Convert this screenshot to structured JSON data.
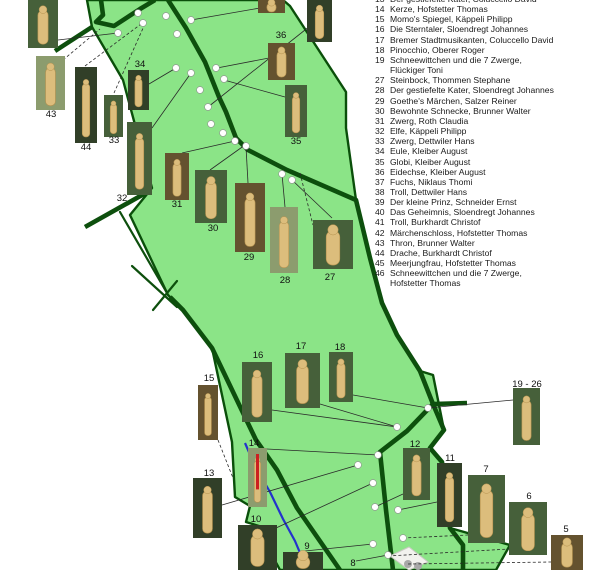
{
  "map": {
    "colors": {
      "park_fill": "#8be487",
      "park_border": "#0a4f0a",
      "trail": "#0d4f0d",
      "stream": "#2433cc",
      "connector": "#2a2a2a",
      "dot_fill": "#ffffff",
      "dot_stroke": "#8f8f8f",
      "gray_dot": "#a8a8a8",
      "building_fill": "#f2f2ee",
      "building_stroke": "#c9c9c2",
      "sculpture": "#dcbd7c",
      "sculpture_edge": "#b5924f",
      "photo_bg": {
        "forest": "#46603a",
        "dark": "#313f28",
        "brown": "#64522f",
        "light": "#8c9c6e"
      }
    },
    "park_polygon": "87,0 283,0 290,6 346,92 346,128 356,200 370,258 382,303 397,335 420,371 433,375 444,430 430,448 442,462 450,528 510,545 496,570 280,570 268,548 272,530 246,522 250,506 235,497 232,442 212,348 183,310 168,295 130,215 152,188 123,80 92,27",
    "trails_thick": [
      "101,0 103,15 96,22 114,26 140,9 155,0",
      "168,0 186,28 205,62 219,97 226,112 236,138 248,150 287,170 356,200 370,258 382,303 397,335 420,371 433,404 444,430 430,448 442,462 450,528 463,545 463,570",
      "92,27 55,51",
      "85,227 151,190",
      "170,297 183,310 212,348 256,440 277,470 297,508 340,570",
      "433,404 407,431 380,452 386,510 393,570",
      "433,404 467,403"
    ],
    "trails_thin": [
      "132,266 177,307",
      "153,310 177,281",
      "120,212 167,293"
    ],
    "stream": "245,443 255,466 270,492 283,519 295,541 303,560 305,568",
    "building": "390,556 409,547 428,562 409,570",
    "dots": [
      [
        118,
        33
      ],
      [
        138,
        13
      ],
      [
        143,
        23
      ],
      [
        166,
        16
      ],
      [
        177,
        34
      ],
      [
        191,
        20
      ],
      [
        176,
        68
      ],
      [
        191,
        73
      ],
      [
        216,
        68
      ],
      [
        224,
        79
      ],
      [
        200,
        90
      ],
      [
        208,
        107
      ],
      [
        211,
        124
      ],
      [
        223,
        133
      ],
      [
        235,
        141
      ],
      [
        246,
        146
      ],
      [
        282,
        174
      ],
      [
        292,
        180
      ],
      [
        428,
        408
      ],
      [
        397,
        427
      ],
      [
        378,
        455
      ],
      [
        358,
        465
      ],
      [
        373,
        483
      ],
      [
        375,
        507
      ],
      [
        398,
        510
      ],
      [
        403,
        538
      ],
      [
        373,
        544
      ],
      [
        388,
        555
      ]
    ],
    "gray_dots": [
      [
        408,
        564
      ],
      [
        418,
        566
      ]
    ],
    "connectors": [
      {
        "p": "58,40 118,33",
        "dash": false
      },
      {
        "p": "63,60 100,29",
        "dash": true
      },
      {
        "p": "85,66 141,24",
        "dash": true
      },
      {
        "p": "114,93 144,26",
        "dash": true
      },
      {
        "p": "149,84 176,68",
        "dash": false
      },
      {
        "p": "152,128 191,73",
        "dash": false
      },
      {
        "p": "182,153 235,141",
        "dash": false
      },
      {
        "p": "210,170 245,145",
        "dash": false
      },
      {
        "p": "248,183 246,147",
        "dash": false
      },
      {
        "p": "285,207 282,174",
        "dash": false
      },
      {
        "p": "332,218 292,180",
        "dash": false
      },
      {
        "p": "300,173 313,225",
        "dash": true
      },
      {
        "p": "260,8 191,20",
        "dash": false
      },
      {
        "p": "310,26 208,107",
        "dash": false
      },
      {
        "p": "269,58 217,68",
        "dash": false
      },
      {
        "p": "285,97 224,80",
        "dash": false
      },
      {
        "p": "320,404 397,427",
        "dash": false
      },
      {
        "p": "353,395 428,408",
        "dash": false
      },
      {
        "p": "272,410 397,427",
        "dash": false
      },
      {
        "p": "218,440 233,478",
        "dash": true
      },
      {
        "p": "267,449 378,455",
        "dash": false
      },
      {
        "p": "222,505 358,465",
        "dash": false
      },
      {
        "p": "276,528 373,483",
        "dash": false
      },
      {
        "p": "305,551 373,544",
        "dash": false
      },
      {
        "p": "356,561 388,555",
        "dash": false
      },
      {
        "p": "403,494 375,507",
        "dash": false
      },
      {
        "p": "437,502 398,510",
        "dash": false
      },
      {
        "p": "403,538 468,535",
        "dash": true
      },
      {
        "p": "388,556 509,549",
        "dash": true
      },
      {
        "p": "408,564 551,562",
        "dash": true
      },
      {
        "p": "428,408 513,400",
        "dash": false
      }
    ],
    "photos": [
      {
        "id": "photo-top-left",
        "x": 28,
        "y": 0,
        "w": 30,
        "h": 48,
        "v": "forest"
      },
      {
        "id": "photo-top-mid",
        "x": 258,
        "y": 0,
        "w": 27,
        "h": 13,
        "v": "brown"
      },
      {
        "id": "photo-top-right",
        "x": 307,
        "y": 0,
        "w": 25,
        "h": 42,
        "v": "dark"
      },
      {
        "id": "photo-43",
        "x": 36,
        "y": 56,
        "w": 29,
        "h": 54,
        "v": "light"
      },
      {
        "id": "photo-44",
        "x": 75,
        "y": 67,
        "w": 22,
        "h": 76,
        "v": "dark"
      },
      {
        "id": "photo-34",
        "x": 128,
        "y": 70,
        "w": 21,
        "h": 40,
        "v": "dark"
      },
      {
        "id": "photo-33",
        "x": 104,
        "y": 95,
        "w": 19,
        "h": 42,
        "v": "forest"
      },
      {
        "id": "photo-36",
        "x": 268,
        "y": 43,
        "w": 27,
        "h": 37,
        "v": "brown"
      },
      {
        "id": "photo-35",
        "x": 285,
        "y": 85,
        "w": 22,
        "h": 52,
        "v": "forest"
      },
      {
        "id": "photo-32",
        "x": 127,
        "y": 122,
        "w": 25,
        "h": 73,
        "v": "forest"
      },
      {
        "id": "photo-31",
        "x": 165,
        "y": 153,
        "w": 24,
        "h": 47,
        "v": "brown"
      },
      {
        "id": "photo-30",
        "x": 195,
        "y": 170,
        "w": 32,
        "h": 53,
        "v": "forest"
      },
      {
        "id": "photo-29",
        "x": 235,
        "y": 183,
        "w": 30,
        "h": 69,
        "v": "brown"
      },
      {
        "id": "photo-28",
        "x": 270,
        "y": 207,
        "w": 28,
        "h": 66,
        "v": "light"
      },
      {
        "id": "photo-27",
        "x": 313,
        "y": 220,
        "w": 40,
        "h": 49,
        "v": "forest"
      },
      {
        "id": "photo-15",
        "x": 198,
        "y": 385,
        "w": 20,
        "h": 55,
        "v": "brown"
      },
      {
        "id": "photo-16",
        "x": 242,
        "y": 362,
        "w": 30,
        "h": 60,
        "v": "forest"
      },
      {
        "id": "photo-17",
        "x": 285,
        "y": 353,
        "w": 35,
        "h": 55,
        "v": "forest"
      },
      {
        "id": "photo-18",
        "x": 329,
        "y": 352,
        "w": 24,
        "h": 50,
        "v": "forest"
      },
      {
        "id": "photo-14",
        "x": 248,
        "y": 448,
        "w": 19,
        "h": 59,
        "v": "light",
        "red": true
      },
      {
        "id": "photo-13",
        "x": 193,
        "y": 478,
        "w": 29,
        "h": 60,
        "v": "dark"
      },
      {
        "id": "photo-10",
        "x": 238,
        "y": 525,
        "w": 39,
        "h": 45,
        "v": "dark"
      },
      {
        "id": "photo-12",
        "x": 403,
        "y": 448,
        "w": 27,
        "h": 52,
        "v": "forest"
      },
      {
        "id": "photo-11",
        "x": 437,
        "y": 463,
        "w": 25,
        "h": 64,
        "v": "dark"
      },
      {
        "id": "photo-7",
        "x": 468,
        "y": 475,
        "w": 37,
        "h": 68,
        "v": "forest"
      },
      {
        "id": "photo-6",
        "x": 509,
        "y": 502,
        "w": 38,
        "h": 53,
        "v": "forest"
      },
      {
        "id": "photo-5",
        "x": 551,
        "y": 535,
        "w": 32,
        "h": 35,
        "v": "brown"
      },
      {
        "id": "photo-19-26",
        "x": 513,
        "y": 388,
        "w": 27,
        "h": 57,
        "v": "forest"
      },
      {
        "id": "photo-bottom",
        "x": 283,
        "y": 552,
        "w": 40,
        "h": 18,
        "v": "dark"
      }
    ],
    "labels": [
      {
        "t": "43",
        "x": 51,
        "y": 117
      },
      {
        "t": "44",
        "x": 86,
        "y": 150
      },
      {
        "t": "33",
        "x": 114,
        "y": 143
      },
      {
        "t": "34",
        "x": 140,
        "y": 67
      },
      {
        "t": "32",
        "x": 122,
        "y": 201
      },
      {
        "t": "31",
        "x": 177,
        "y": 207
      },
      {
        "t": "30",
        "x": 213,
        "y": 231
      },
      {
        "t": "29",
        "x": 249,
        "y": 260
      },
      {
        "t": "28",
        "x": 285,
        "y": 283
      },
      {
        "t": "27",
        "x": 330,
        "y": 280
      },
      {
        "t": "36",
        "x": 281,
        "y": 38
      },
      {
        "t": "35",
        "x": 296,
        "y": 144
      },
      {
        "t": "15",
        "x": 209,
        "y": 381
      },
      {
        "t": "16",
        "x": 258,
        "y": 358
      },
      {
        "t": "17",
        "x": 301,
        "y": 349
      },
      {
        "t": "18",
        "x": 340,
        "y": 350
      },
      {
        "t": "14",
        "x": 254,
        "y": 446
      },
      {
        "t": "13",
        "x": 209,
        "y": 476
      },
      {
        "t": "10",
        "x": 256,
        "y": 522
      },
      {
        "t": "12",
        "x": 415,
        "y": 447
      },
      {
        "t": "11",
        "x": 450,
        "y": 461
      },
      {
        "t": "7",
        "x": 486,
        "y": 472
      },
      {
        "t": "6",
        "x": 529,
        "y": 499
      },
      {
        "t": "5",
        "x": 566,
        "y": 532
      },
      {
        "t": "19 - 26",
        "x": 527,
        "y": 387
      },
      {
        "t": "9",
        "x": 307,
        "y": 549
      },
      {
        "t": "8",
        "x": 353,
        "y": 566
      }
    ]
  },
  "legend": {
    "entries": [
      {
        "n": "13",
        "t": "Der gestiefelte Kater, Coluccello David"
      },
      {
        "n": "14",
        "t": "Kerze, Hofstetter Thomas"
      },
      {
        "n": "15",
        "t": "Momo's Spiegel, Käppeli Philipp"
      },
      {
        "n": "16",
        "t": "Die Sterntaler, Sloendregt Johannes"
      },
      {
        "n": "17",
        "t": "Bremer Stadtmusikanten, Coluccello David"
      },
      {
        "n": "18",
        "t": "Pinocchio, Oberer Roger"
      },
      {
        "n": "19",
        "t": "Schneewittchen und die 7 Zwerge,"
      },
      {
        "n": "",
        "t": "Flückiger Toni"
      },
      {
        "n": "27",
        "t": "Steinbock, Thommen Stephane"
      },
      {
        "n": "28",
        "t": "Der gestiefelte Kater, Sloendregt Johannes"
      },
      {
        "n": "29",
        "t": "Goethe's Märchen, Salzer Reiner"
      },
      {
        "n": "30",
        "t": "Bewohnte Schnecke, Brunner Walter"
      },
      {
        "n": "31",
        "t": "Zwerg, Roth Claudia"
      },
      {
        "n": "32",
        "t": "Elfe, Käppeli Philipp"
      },
      {
        "n": "33",
        "t": "Zwerg, Dettwiler Hans"
      },
      {
        "n": "34",
        "t": "Eule,  Kleiber August"
      },
      {
        "n": "35",
        "t": "Globi, Kleiber August"
      },
      {
        "n": "36",
        "t": "Eidechse,  Kleiber August"
      },
      {
        "n": "37",
        "t": "Fuchs, Niklaus Thomi"
      },
      {
        "n": "38",
        "t": "Troll,  Dettwiler Hans"
      },
      {
        "n": "39",
        "t": "Der kleine Prinz, Schneider Ernst"
      },
      {
        "n": "40",
        "t": "Das Geheimnis,  Sloendregt Johannes"
      },
      {
        "n": "41",
        "t": "Troll,  Burkhardt Christof"
      },
      {
        "n": "42",
        "t": "Märchenschloss, Hofstetter Thomas"
      },
      {
        "n": "43",
        "t": "Thron,  Brunner Walter"
      },
      {
        "n": "44",
        "t": "Drache, Burkhardt Christof"
      },
      {
        "n": "45",
        "t": "Meerjungfrau, Hofstetter Thomas"
      },
      {
        "n": "46",
        "t": "Schneewittchen und die 7 Zwerge,"
      },
      {
        "n": "",
        "t": "Hofstetter Thomas"
      }
    ]
  }
}
